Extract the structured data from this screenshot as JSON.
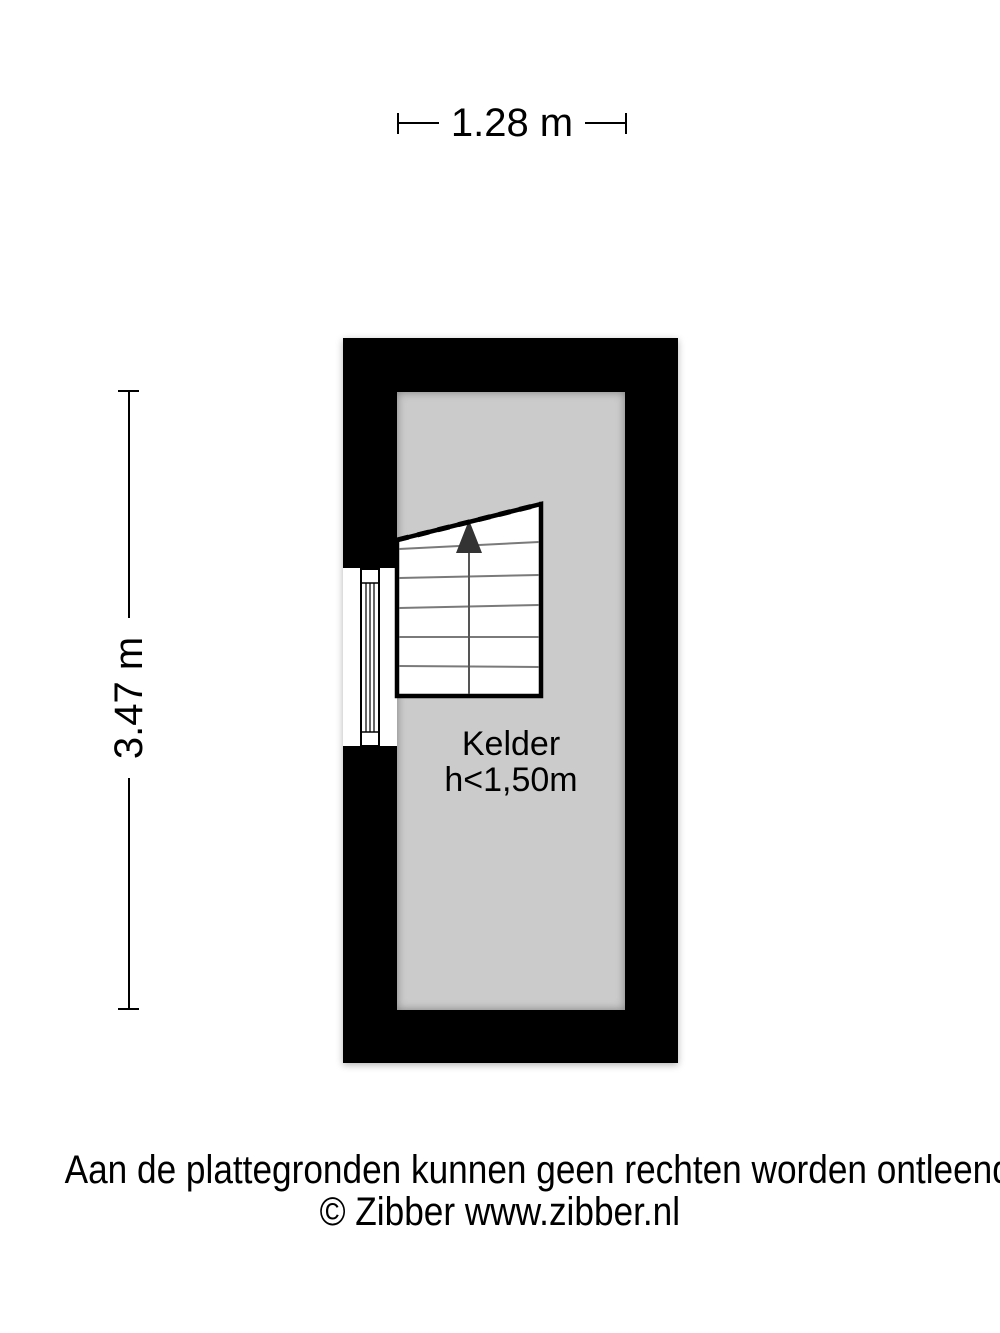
{
  "dimensions": {
    "width": "1.28 m",
    "height": "3.47 m"
  },
  "room": {
    "name": "Kelder",
    "height_note": "h<1,50m"
  },
  "footer": {
    "disclaimer": "Aan de plattegronden kunnen geen rechten worden ontleend",
    "copyright": "© Zibber www.zibber.nl"
  },
  "colors": {
    "wall": "#000000",
    "floor": "#cbcbcb",
    "background": "#ffffff",
    "stair_step_line": "#7a7a7a",
    "stair_arrow": "#333333"
  },
  "icons": {
    "staircase": "staircase-up-icon",
    "window": "window-icon"
  }
}
